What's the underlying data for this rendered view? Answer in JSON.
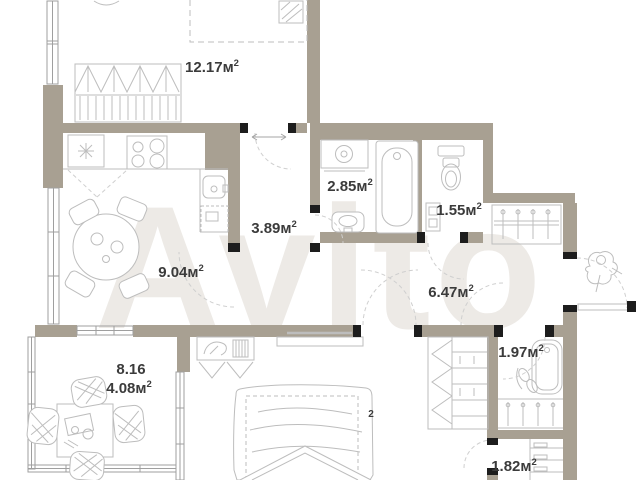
{
  "watermark_text": "Avito",
  "colors": {
    "wall": "#a8a092",
    "door_frame": "#1d1d1d",
    "furniture_line": "#bdbdbd",
    "window_line": "#9f9f9f",
    "swing_line": "#cfcfcf",
    "label_text": "#3b3b3b",
    "watermark": "#edeae6"
  },
  "areas": {
    "room_top": {
      "label": "12.17м",
      "sup": "2"
    },
    "kitchen": {
      "label": "9.04м",
      "sup": "2"
    },
    "hall_small": {
      "label": "3.89м",
      "sup": "2"
    },
    "bath_main": {
      "label": "2.85м",
      "sup": "2"
    },
    "wc": {
      "label": "1.55м",
      "sup": "2"
    },
    "hall_main": {
      "label": "6.47м",
      "sup": "2"
    },
    "bath_second": {
      "label": "1.97м",
      "sup": "2"
    },
    "storage": {
      "label": "1.82м",
      "sup": "2"
    },
    "balcony_full": {
      "label": "8.16",
      "sup": ""
    },
    "balcony_reduced": {
      "label": "4.08м",
      "sup": "2"
    },
    "bedroom_hidden": {
      "label": "",
      "sup": "2"
    }
  }
}
